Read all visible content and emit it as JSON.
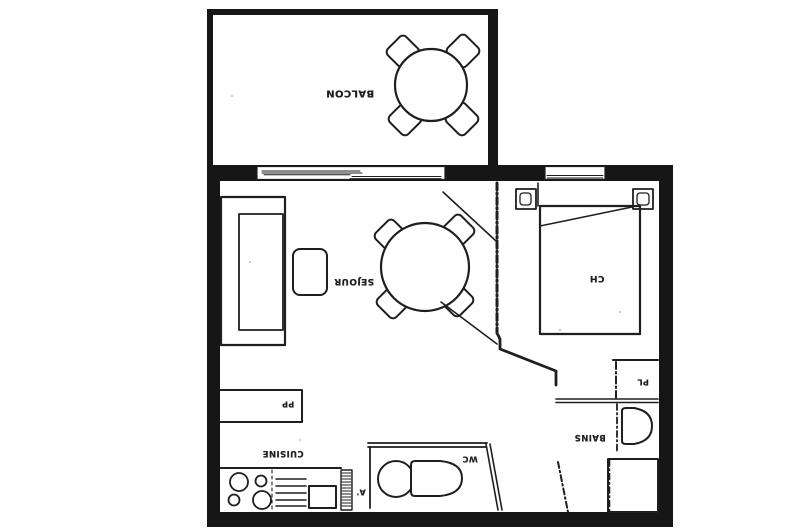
{
  "plan": {
    "rooms": {
      "balcony": {
        "label": "BALCON"
      },
      "living": {
        "label": "SEJOUR"
      },
      "bedroom": {
        "label": "CH"
      },
      "bathroom": {
        "label": "BAINS"
      },
      "wc": {
        "label": "WC"
      },
      "kitchen": {
        "label": "CUISINE"
      },
      "closet_pl": {
        "label": "PL"
      },
      "closet_pp": {
        "label": "PP"
      }
    },
    "marker": {
      "label": "A'"
    },
    "colors": {
      "paper": "#ffffff",
      "wall_ink": "#161616",
      "line_ink": "#1f1f1f"
    }
  }
}
